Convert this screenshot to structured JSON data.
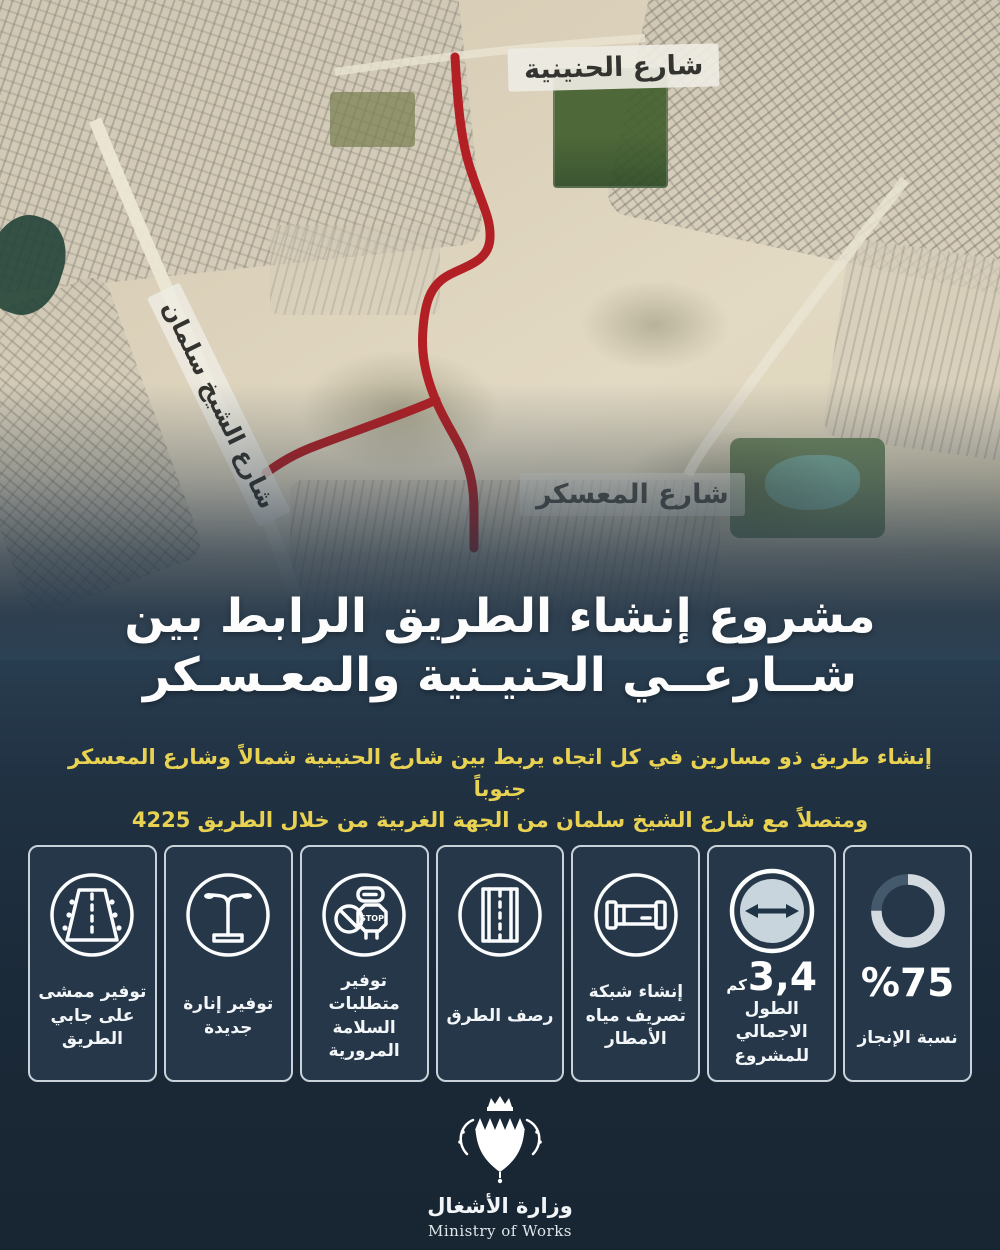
{
  "map": {
    "labels": {
      "hanainiya": "شارع الحنينية",
      "salman": "شارع الشيخ سلمان",
      "muaskar": "شارع المعسكر"
    },
    "road_color": "#b22025"
  },
  "title": {
    "line1": "مشروع إنشاء الطريق الرابط بين",
    "line2": "شــارعــي الحنيـنية والمعـسـكر"
  },
  "subtitle": {
    "line1": "إنشاء طريق ذو مسارين في كل اتجاه يربط بين شارع الحنينية شمالاً وشارع المعسكر جنوباً",
    "line2": "ومتصلاً مع شارع الشيخ سلمان من الجهة الغربية من خلال الطريق 4225",
    "color": "#e9d252"
  },
  "cards": [
    {
      "id": "completion",
      "icon": "donut-chart-icon",
      "percent": 75,
      "value": "%75",
      "label": "نسبة الإنجاز"
    },
    {
      "id": "total-length",
      "icon": "double-arrow-icon",
      "value": "3,4",
      "unit": "كم",
      "label": "الطول الاجمالي للمشروع"
    },
    {
      "id": "drainage",
      "icon": "pipe-icon",
      "label": "إنشاء شبكة تصريف مياه الأمطار"
    },
    {
      "id": "paving",
      "icon": "road-icon",
      "label": "رصف الطرق"
    },
    {
      "id": "safety",
      "icon": "traffic-signs-icon",
      "icon_text": "STOP",
      "label": "توفير متطلبات السلامة المرورية"
    },
    {
      "id": "lighting",
      "icon": "street-lamp-icon",
      "label": "توفير إنارة جديدة"
    },
    {
      "id": "walkway",
      "icon": "road-walkway-icon",
      "label": "توفير ممشى على جابي الطريق"
    }
  ],
  "footer": {
    "ministry_ar": "وزارة الأشغال",
    "ministry_en": "Ministry of Works"
  },
  "colors": {
    "background_navy": "#1b2937",
    "card_background": "#253748",
    "card_border": "#c9d2d9",
    "accent_red": "#b22025",
    "subtitle_yellow": "#e9d252",
    "donut_fill": "#d3dbe1",
    "donut_track": "#45596c"
  }
}
